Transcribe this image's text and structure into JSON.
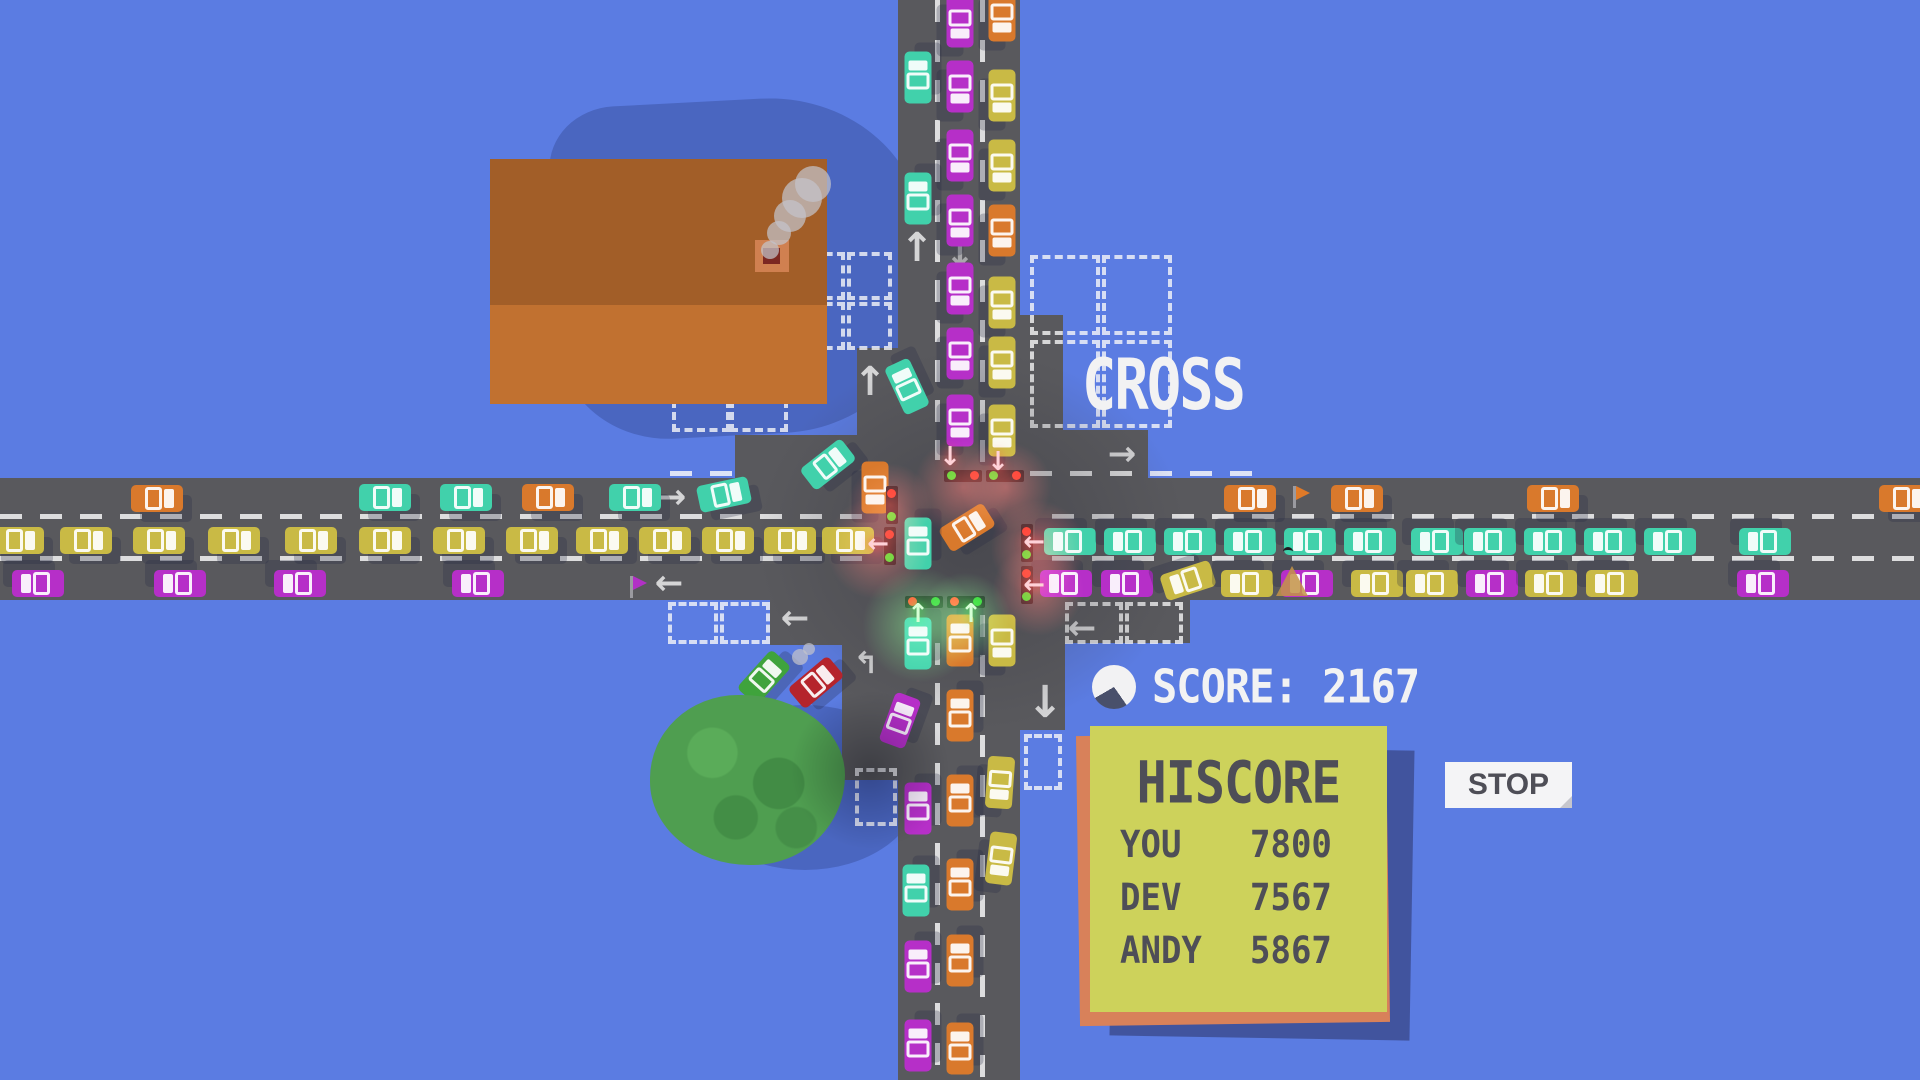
{
  "hud": {
    "title": "CROSS",
    "score_label": "SCORE:",
    "score_value": "2167",
    "score_icon": "timer-pie-icon",
    "stop_label": "STOP",
    "hiscore": {
      "title": "HISCORE",
      "entries": [
        {
          "name": "YOU",
          "score": "7800"
        },
        {
          "name": "DEV",
          "score": "7567"
        },
        {
          "name": "ANDY",
          "score": "5867"
        }
      ]
    }
  },
  "palette": {
    "css_vars": {
      "bg": "#5b7ce2",
      "shadow": "#4a66c0",
      "road": "#59595d",
      "text-dark": "#4e4e57",
      "hud-white": "#f2f2f3",
      "panel-yellow": "#cdd25b",
      "panel-orange": "#d8815a",
      "panel-shadow": "#41549e",
      "btn-white": "#f4f4f6",
      "tree": "#4f9e50",
      "roof-top": "#a25e28",
      "roof-bottom": "#c17130"
    },
    "cars": {
      "o": "#d9792c",
      "t": "#41d1ab",
      "y": "#c9ba45",
      "p": "#b62fc8",
      "r": "#b5242c",
      "g": "#3fa33c"
    },
    "light_red": "#ff3b30",
    "light_green": "#35d435",
    "glow_red": "rgba(255,70,58,0.5)",
    "glow_green": "rgba(90,255,96,0.5)",
    "glow_dark": "rgba(25,30,55,0.35)"
  },
  "scene": {
    "roads": [
      [
        0,
        478,
        1920,
        122
      ],
      [
        898,
        0,
        122,
        1080
      ],
      [
        857,
        348,
        41,
        130
      ],
      [
        735,
        435,
        163,
        43
      ],
      [
        1020,
        315,
        43,
        163
      ],
      [
        1020,
        430,
        128,
        48
      ],
      [
        770,
        600,
        128,
        45
      ],
      [
        842,
        600,
        56,
        180
      ],
      [
        1020,
        600,
        170,
        43
      ],
      [
        1020,
        600,
        45,
        130
      ]
    ],
    "lane_lines_h": [
      [
        0,
        514,
        875
      ],
      [
        1052,
        514,
        868
      ],
      [
        0,
        556,
        880
      ],
      [
        1052,
        556,
        868
      ],
      [
        1030,
        471,
        230
      ],
      [
        670,
        471,
        68
      ]
    ],
    "lane_lines_v": [
      [
        935,
        0,
        460
      ],
      [
        980,
        0,
        468
      ],
      [
        935,
        643,
        437
      ],
      [
        980,
        615,
        465
      ]
    ],
    "crosswalks": [
      [
        672,
        376,
        58,
        56
      ],
      [
        730,
        376,
        58,
        56
      ],
      [
        668,
        602,
        50,
        42
      ],
      [
        720,
        602,
        50,
        42
      ],
      [
        800,
        252,
        45,
        48
      ],
      [
        847,
        252,
        45,
        48
      ],
      [
        800,
        302,
        45,
        48
      ],
      [
        847,
        302,
        45,
        48
      ],
      [
        1030,
        255,
        70,
        80
      ],
      [
        1102,
        255,
        70,
        80
      ],
      [
        1030,
        340,
        70,
        88
      ],
      [
        1102,
        340,
        70,
        88
      ],
      [
        1065,
        602,
        58,
        42
      ],
      [
        1125,
        602,
        58,
        42
      ],
      [
        855,
        768,
        42,
        58
      ],
      [
        1024,
        734,
        38,
        56
      ]
    ],
    "painted_arrows": [
      [
        672,
        497,
        "→",
        34,
        0.85
      ],
      [
        1122,
        454,
        "→",
        34,
        0.85
      ],
      [
        795,
        618,
        "←",
        34,
        0.85
      ],
      [
        669,
        583,
        "←",
        34,
        0.85
      ],
      [
        1082,
        628,
        "←",
        34,
        0.85
      ],
      [
        917,
        248,
        "↑",
        40,
        0.85
      ],
      [
        870,
        382,
        "↑",
        40,
        0.85
      ],
      [
        960,
        255,
        "↓",
        36,
        0.55
      ],
      [
        1045,
        703,
        "↓",
        44,
        0.85
      ],
      [
        866,
        664,
        "↰",
        30,
        0.85
      ]
    ],
    "cars": [
      [
        157,
        498,
        "o",
        0
      ],
      [
        385,
        497,
        "t",
        0
      ],
      [
        466,
        497,
        "t",
        0
      ],
      [
        548,
        497,
        "o",
        0
      ],
      [
        635,
        497,
        "t",
        0
      ],
      [
        724,
        494,
        "t",
        -12
      ],
      [
        828,
        464,
        "t",
        -38
      ],
      [
        875,
        487,
        "o",
        90
      ],
      [
        18,
        540,
        "y",
        0
      ],
      [
        86,
        540,
        "y",
        0
      ],
      [
        159,
        540,
        "y",
        0
      ],
      [
        234,
        540,
        "y",
        0
      ],
      [
        311,
        540,
        "y",
        0
      ],
      [
        385,
        540,
        "y",
        0
      ],
      [
        459,
        540,
        "y",
        0
      ],
      [
        532,
        540,
        "y",
        0
      ],
      [
        602,
        540,
        "y",
        0
      ],
      [
        665,
        540,
        "y",
        0
      ],
      [
        728,
        540,
        "y",
        0
      ],
      [
        790,
        540,
        "y",
        0
      ],
      [
        848,
        540,
        "y",
        0
      ],
      [
        38,
        583,
        "p",
        180
      ],
      [
        180,
        583,
        "p",
        180
      ],
      [
        300,
        583,
        "p",
        180
      ],
      [
        478,
        583,
        "p",
        180
      ],
      [
        1250,
        498,
        "o",
        0
      ],
      [
        1357,
        498,
        "o",
        0
      ],
      [
        1553,
        498,
        "o",
        0
      ],
      [
        1905,
        498,
        "o",
        0
      ],
      [
        1070,
        541,
        "t",
        180
      ],
      [
        1130,
        541,
        "t",
        180
      ],
      [
        1190,
        541,
        "t",
        180
      ],
      [
        1250,
        541,
        "t",
        180
      ],
      [
        1310,
        541,
        "t",
        180
      ],
      [
        1370,
        541,
        "t",
        180
      ],
      [
        1437,
        541,
        "t",
        180
      ],
      [
        1490,
        541,
        "t",
        180
      ],
      [
        1550,
        541,
        "t",
        180
      ],
      [
        1610,
        541,
        "t",
        180
      ],
      [
        1670,
        541,
        "t",
        180
      ],
      [
        1765,
        541,
        "t",
        180
      ],
      [
        1066,
        583,
        "p",
        180
      ],
      [
        1127,
        583,
        "p",
        180
      ],
      [
        1188,
        580,
        "y",
        162
      ],
      [
        1247,
        583,
        "y",
        180
      ],
      [
        1307,
        583,
        "p",
        180
      ],
      [
        1377,
        583,
        "y",
        180
      ],
      [
        1432,
        583,
        "y",
        180
      ],
      [
        1492,
        583,
        "p",
        180
      ],
      [
        1551,
        583,
        "y",
        180
      ],
      [
        1612,
        583,
        "y",
        180
      ],
      [
        1763,
        583,
        "p",
        180
      ],
      [
        918,
        77,
        "t",
        -90
      ],
      [
        918,
        198,
        "t",
        -90
      ],
      [
        907,
        386,
        "t",
        -115
      ],
      [
        960,
        21,
        "p",
        90
      ],
      [
        960,
        86,
        "p",
        90
      ],
      [
        960,
        155,
        "p",
        90
      ],
      [
        960,
        220,
        "p",
        90
      ],
      [
        960,
        288,
        "p",
        90
      ],
      [
        960,
        353,
        "p",
        90
      ],
      [
        960,
        420,
        "p",
        90
      ],
      [
        1002,
        15,
        "o",
        90
      ],
      [
        1002,
        95,
        "y",
        90
      ],
      [
        1002,
        165,
        "y",
        90
      ],
      [
        1002,
        230,
        "o",
        90
      ],
      [
        1002,
        302,
        "y",
        90
      ],
      [
        1002,
        362,
        "y",
        90
      ],
      [
        1002,
        430,
        "y",
        90
      ],
      [
        967,
        527,
        "o",
        -32
      ],
      [
        918,
        543,
        "t",
        -90
      ],
      [
        918,
        643,
        "t",
        -90
      ],
      [
        900,
        720,
        "p",
        -70
      ],
      [
        918,
        808,
        "p",
        -90
      ],
      [
        916,
        890,
        "t",
        -90
      ],
      [
        918,
        966,
        "p",
        -90
      ],
      [
        918,
        1045,
        "p",
        -90
      ],
      [
        960,
        640,
        "o",
        -90
      ],
      [
        960,
        715,
        "o",
        -90
      ],
      [
        960,
        800,
        "o",
        -90
      ],
      [
        960,
        884,
        "o",
        -90
      ],
      [
        960,
        960,
        "o",
        -90
      ],
      [
        960,
        1048,
        "o",
        -90
      ],
      [
        1002,
        640,
        "y",
        90
      ],
      [
        1000,
        782,
        "y",
        94
      ],
      [
        1001,
        858,
        "y",
        97
      ],
      [
        764,
        677,
        "g",
        -48
      ],
      [
        816,
        682,
        "r",
        -40
      ]
    ],
    "lights": [
      [
        944,
        470,
        38,
        12,
        "gr"
      ],
      [
        986,
        470,
        38,
        12,
        "gr"
      ],
      [
        886,
        486,
        12,
        38,
        "rg"
      ],
      [
        884,
        527,
        12,
        38,
        "rg"
      ],
      [
        1021,
        524,
        12,
        38,
        "rg"
      ],
      [
        1021,
        566,
        12,
        38,
        "rg"
      ],
      [
        905,
        596,
        38,
        12,
        "rg"
      ],
      [
        947,
        596,
        38,
        12,
        "rg"
      ]
    ],
    "glows": [
      [
        963,
        487,
        50,
        "red"
      ],
      [
        1006,
        487,
        46,
        "red"
      ],
      [
        890,
        505,
        42,
        "red"
      ],
      [
        878,
        548,
        52,
        "red"
      ],
      [
        1038,
        548,
        48,
        "red"
      ],
      [
        1038,
        590,
        46,
        "red"
      ],
      [
        920,
        625,
        58,
        "green"
      ],
      [
        965,
        618,
        46,
        "green"
      ],
      [
        870,
        770,
        80,
        "dark"
      ]
    ],
    "glow_arrows": [
      [
        878,
        544,
        "←",
        "pink"
      ],
      [
        1034,
        542,
        "←",
        "pink"
      ],
      [
        1034,
        585,
        "←",
        "pink"
      ],
      [
        998,
        462,
        "↓",
        "pink"
      ],
      [
        950,
        457,
        "↓",
        "pink"
      ],
      [
        918,
        614,
        "↑",
        "green"
      ],
      [
        971,
        614,
        "↑",
        "green"
      ]
    ],
    "flags": [
      [
        1293,
        486,
        "#e07a28"
      ],
      [
        630,
        576,
        "#b230c6"
      ]
    ],
    "warn_triangles": [
      [
        1292,
        581
      ]
    ],
    "birds": [
      [
        1283,
        547
      ]
    ],
    "smoke": [
      [
        770,
        250,
        9
      ],
      [
        779,
        233,
        12
      ],
      [
        790,
        216,
        16
      ],
      [
        802,
        198,
        20
      ],
      [
        813,
        184,
        18
      ],
      [
        800,
        657,
        8
      ],
      [
        809,
        649,
        6
      ]
    ],
    "building": {
      "shadow": [
        555,
        100,
        370,
        335
      ],
      "roof_top": [
        490,
        159,
        337,
        146
      ],
      "roof_bottom": [
        490,
        305,
        337,
        99
      ],
      "chimney": [
        755,
        240,
        34,
        32
      ]
    },
    "tree": {
      "shadow": [
        690,
        705,
        230,
        165
      ],
      "canopy": [
        650,
        695,
        195,
        170
      ]
    },
    "haze": [
      757,
      350,
      430,
      380
    ]
  }
}
